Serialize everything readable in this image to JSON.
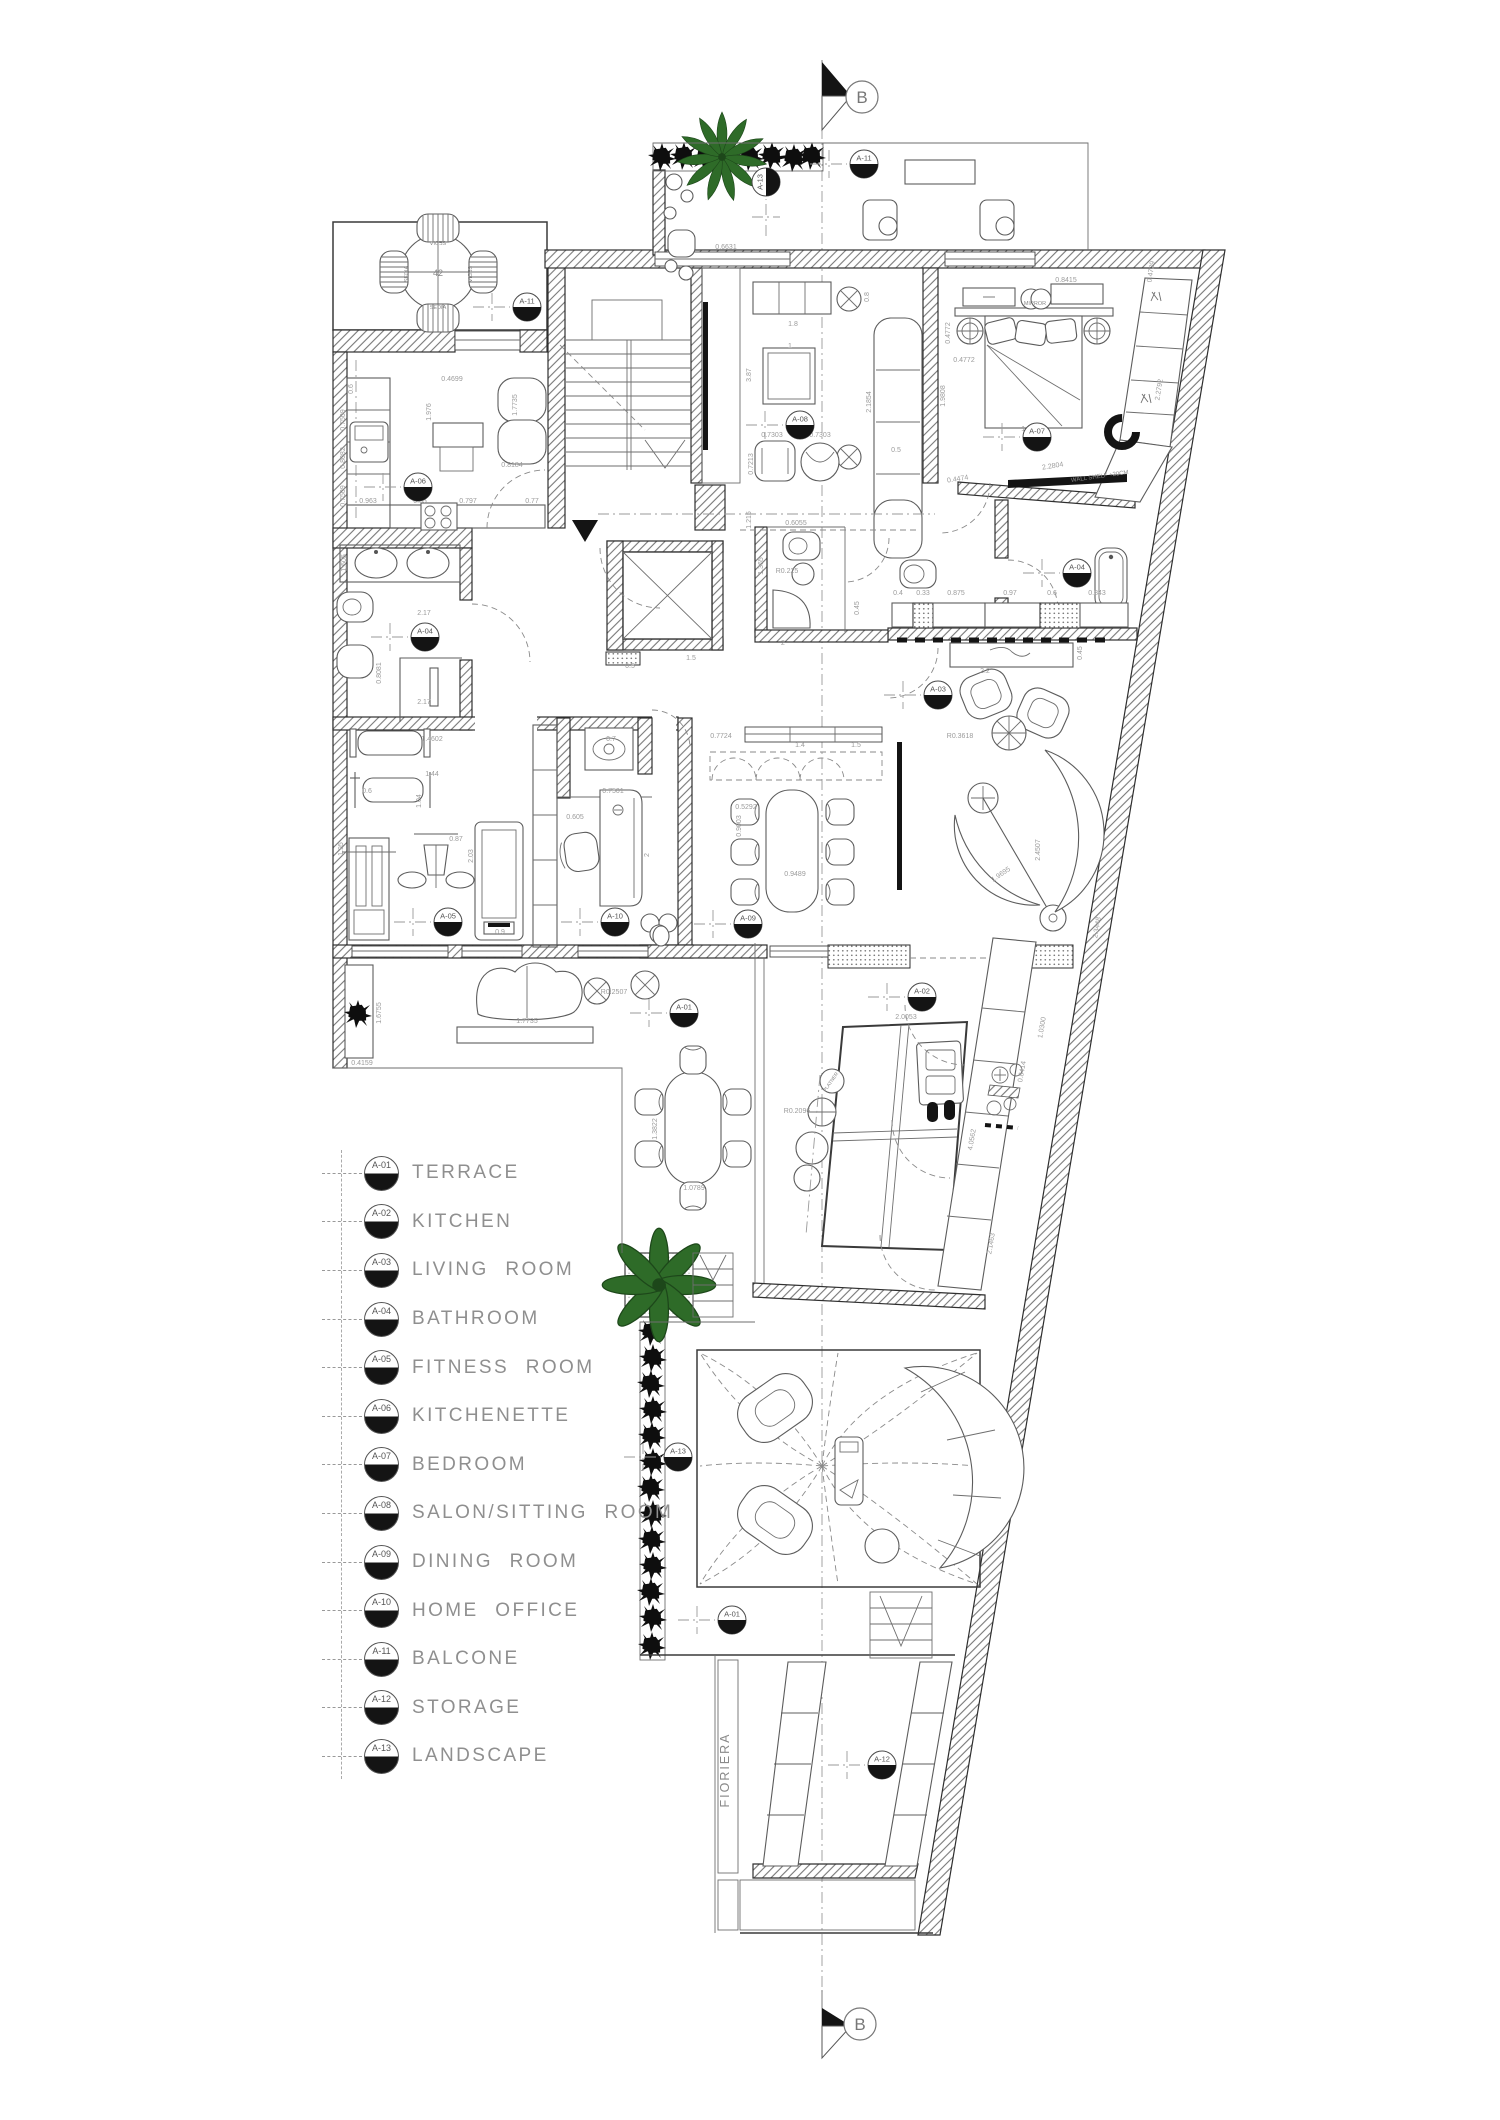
{
  "section": {
    "label": "B"
  },
  "legend": {
    "items": [
      {
        "id": "A-01",
        "label": "TERRACE"
      },
      {
        "id": "A-02",
        "label": "KITCHEN"
      },
      {
        "id": "A-03",
        "label": "LIVING ROOM"
      },
      {
        "id": "A-04",
        "label": "BATHROOM"
      },
      {
        "id": "A-05",
        "label": "FITNESS ROOM"
      },
      {
        "id": "A-06",
        "label": "KITCHENETTE"
      },
      {
        "id": "A-07",
        "label": "BEDROOM"
      },
      {
        "id": "A-08",
        "label": "SALON/SITTING ROOM"
      },
      {
        "id": "A-09",
        "label": "DINING ROOM"
      },
      {
        "id": "A-10",
        "label": "HOME OFFICE"
      },
      {
        "id": "A-11",
        "label": "BALCONE"
      },
      {
        "id": "A-12",
        "label": "STORAGE"
      },
      {
        "id": "A-13",
        "label": "LANDSCAPE"
      }
    ]
  },
  "plan": {
    "colors": {
      "wall": "#2f2f2f",
      "dim_text": "#9b9b9b",
      "label_text": "#8a8a8a",
      "plant_green": "#2e6b28",
      "hedge_black": "#111111",
      "legend_text": "#8f8f8f"
    },
    "markers": [
      {
        "id": "A-11",
        "x": 527,
        "y": 307
      },
      {
        "id": "A-13",
        "x": 766,
        "y": 182,
        "r": -90
      },
      {
        "id": "A-11",
        "x": 864,
        "y": 164
      },
      {
        "id": "A-08",
        "x": 800,
        "y": 425
      },
      {
        "id": "A-07",
        "x": 1037,
        "y": 437
      },
      {
        "id": "A-06",
        "x": 418,
        "y": 487
      },
      {
        "id": "A-04",
        "x": 425,
        "y": 637
      },
      {
        "id": "A-04",
        "x": 1077,
        "y": 573
      },
      {
        "id": "A-03",
        "x": 938,
        "y": 695
      },
      {
        "id": "A-05",
        "x": 448,
        "y": 922
      },
      {
        "id": "A-10",
        "x": 615,
        "y": 922
      },
      {
        "id": "A-09",
        "x": 748,
        "y": 924
      },
      {
        "id": "A-01",
        "x": 684,
        "y": 1013
      },
      {
        "id": "A-02",
        "x": 922,
        "y": 997
      },
      {
        "id": "A-13",
        "x": 678,
        "y": 1457
      },
      {
        "id": "A-01",
        "x": 732,
        "y": 1620
      },
      {
        "id": "A-12",
        "x": 882,
        "y": 1765
      }
    ],
    "dimensions": [
      {
        "t": "0.6631",
        "x": 726,
        "y": 249
      },
      {
        "t": "3.87",
        "x": 751,
        "y": 375,
        "r": -90
      },
      {
        "t": "1.215",
        "x": 751,
        "y": 520,
        "r": -90
      },
      {
        "t": "1.8",
        "x": 793,
        "y": 326
      },
      {
        "t": "1",
        "x": 790,
        "y": 348
      },
      {
        "t": "0.8",
        "x": 869,
        "y": 297,
        "r": -90
      },
      {
        "t": "2.1854",
        "x": 871,
        "y": 402,
        "r": -90
      },
      {
        "t": "0.7303",
        "x": 772,
        "y": 437
      },
      {
        "t": "0.7303",
        "x": 820,
        "y": 437
      },
      {
        "t": "0.7213",
        "x": 753,
        "y": 464,
        "r": -90
      },
      {
        "t": "0.5",
        "x": 896,
        "y": 452
      },
      {
        "t": "0.8415",
        "x": 1066,
        "y": 282
      },
      {
        "t": "0.4772",
        "x": 950,
        "y": 333,
        "r": -90
      },
      {
        "t": "0.4772",
        "x": 964,
        "y": 362
      },
      {
        "t": "1.9808",
        "x": 945,
        "y": 396,
        "r": -90
      },
      {
        "t": "1.7455",
        "x": 1032,
        "y": 431
      },
      {
        "t": "2.2804",
        "x": 1053,
        "y": 468,
        "r": -9
      },
      {
        "t": "0.4474",
        "x": 958,
        "y": 481,
        "r": -9
      },
      {
        "t": "2.2792",
        "x": 1161,
        "y": 390,
        "r": -81
      },
      {
        "t": "0.4729",
        "x": 1153,
        "y": 272,
        "r": -81
      },
      {
        "t": "0.4699",
        "x": 452,
        "y": 381
      },
      {
        "t": "1.976",
        "x": 431,
        "y": 412,
        "r": -90
      },
      {
        "t": "1.7735",
        "x": 517,
        "y": 405,
        "r": -90
      },
      {
        "t": "0.8184",
        "x": 512,
        "y": 467
      },
      {
        "t": "0.963",
        "x": 368,
        "y": 503
      },
      {
        "t": "0.55",
        "x": 420,
        "y": 503
      },
      {
        "t": "0.797",
        "x": 468,
        "y": 503
      },
      {
        "t": "0.77",
        "x": 532,
        "y": 503
      },
      {
        "t": "0.6",
        "x": 353,
        "y": 389,
        "r": -90
      },
      {
        "t": "0.7509",
        "x": 345,
        "y": 420,
        "r": -90
      },
      {
        "t": "0.8082",
        "x": 345,
        "y": 458,
        "r": -90
      },
      {
        "t": "0.7509",
        "x": 345,
        "y": 496,
        "r": -90
      },
      {
        "t": "2.17",
        "x": 424,
        "y": 615
      },
      {
        "t": "2.17",
        "x": 424,
        "y": 704
      },
      {
        "t": "1.505",
        "x": 346,
        "y": 563,
        "r": -90
      },
      {
        "t": "0.8081",
        "x": 381,
        "y": 673,
        "r": -90
      },
      {
        "t": "1.4602",
        "x": 432,
        "y": 741
      },
      {
        "t": "1.44",
        "x": 432,
        "y": 776
      },
      {
        "t": "0.6",
        "x": 367,
        "y": 793
      },
      {
        "t": "1.95",
        "x": 343,
        "y": 849,
        "r": -90
      },
      {
        "t": "1.04",
        "x": 421,
        "y": 801,
        "r": -90
      },
      {
        "t": "0.87",
        "x": 456,
        "y": 841
      },
      {
        "t": "2.03",
        "x": 473,
        "y": 856,
        "r": -90
      },
      {
        "t": "0.9",
        "x": 500,
        "y": 934
      },
      {
        "t": "0.7",
        "x": 611,
        "y": 741
      },
      {
        "t": "0.7501",
        "x": 613,
        "y": 793
      },
      {
        "t": "0.605",
        "x": 575,
        "y": 819
      },
      {
        "t": "2",
        "x": 649,
        "y": 855,
        "r": -90
      },
      {
        "t": "0.7724",
        "x": 721,
        "y": 738
      },
      {
        "t": "1.4",
        "x": 800,
        "y": 747
      },
      {
        "t": "1.5",
        "x": 856,
        "y": 747
      },
      {
        "t": "0.5292",
        "x": 746,
        "y": 809
      },
      {
        "t": "0.9003",
        "x": 741,
        "y": 826,
        "r": -90
      },
      {
        "t": "0.9489",
        "x": 795,
        "y": 876
      },
      {
        "t": "0.5",
        "x": 630,
        "y": 668
      },
      {
        "t": "1.5",
        "x": 691,
        "y": 660
      },
      {
        "t": "2",
        "x": 783,
        "y": 645
      },
      {
        "t": "1.365",
        "x": 763,
        "y": 566,
        "r": -90
      },
      {
        "t": "0.6055",
        "x": 796,
        "y": 525
      },
      {
        "t": "R0.225",
        "x": 787,
        "y": 573
      },
      {
        "t": "0.4",
        "x": 898,
        "y": 595
      },
      {
        "t": "0.33",
        "x": 923,
        "y": 595
      },
      {
        "t": "0.875",
        "x": 956,
        "y": 595
      },
      {
        "t": "0.97",
        "x": 1010,
        "y": 595
      },
      {
        "t": "0.6",
        "x": 1052,
        "y": 595
      },
      {
        "t": "0.843",
        "x": 1097,
        "y": 595
      },
      {
        "t": "0.45",
        "x": 859,
        "y": 608,
        "r": -90
      },
      {
        "t": "2.2",
        "x": 985,
        "y": 673
      },
      {
        "t": "0.45",
        "x": 1082,
        "y": 653,
        "r": -90
      },
      {
        "t": "R0.3618",
        "x": 960,
        "y": 738
      },
      {
        "t": "2.4507",
        "x": 1040,
        "y": 850,
        "r": -90
      },
      {
        "t": "1.9695",
        "x": 1002,
        "y": 876,
        "r": -34
      },
      {
        "t": "2.3448",
        "x": 1099,
        "y": 928,
        "r": -80
      },
      {
        "t": "1.6755",
        "x": 381,
        "y": 1013,
        "r": -90
      },
      {
        "t": "0.4159",
        "x": 362,
        "y": 1065
      },
      {
        "t": "1.7735",
        "x": 527,
        "y": 1023
      },
      {
        "t": "R0.2507",
        "x": 614,
        "y": 994
      },
      {
        "t": "1.3822",
        "x": 657,
        "y": 1129,
        "r": -90
      },
      {
        "t": "1.0789",
        "x": 694,
        "y": 1190
      },
      {
        "t": "2.0053",
        "x": 906,
        "y": 1019
      },
      {
        "t": "R0.2096",
        "x": 797,
        "y": 1113
      },
      {
        "t": "4.0562",
        "x": 974,
        "y": 1140,
        "r": -80
      },
      {
        "t": "1.0300",
        "x": 1044,
        "y": 1028,
        "r": -80
      },
      {
        "t": "0.8414",
        "x": 1024,
        "y": 1072,
        "r": -80
      },
      {
        "t": "2.1463",
        "x": 993,
        "y": 1244,
        "r": -80
      }
    ],
    "texts": [
      {
        "t": "42",
        "x": 438,
        "y": 276,
        "s": 9
      },
      {
        "t": "SEDIA",
        "x": 438,
        "y": 241,
        "s": 5.5,
        "r": 180
      },
      {
        "t": "SEDIA",
        "x": 438,
        "y": 309,
        "s": 5.5
      },
      {
        "t": "SEDIA",
        "x": 408,
        "y": 274,
        "s": 5.5,
        "r": -90
      },
      {
        "t": "SEDIA",
        "x": 468,
        "y": 274,
        "s": 5.5,
        "r": 90
      },
      {
        "t": "MIRROR",
        "x": 1035,
        "y": 305,
        "s": 5.5
      },
      {
        "t": "WALL SHELF +20CM",
        "x": 1100,
        "y": 478,
        "s": 6,
        "r": -8
      },
      {
        "t": "PLATNER",
        "x": 832,
        "y": 1083,
        "s": 5,
        "r": -55
      },
      {
        "t": "FIORIERA",
        "x": 729,
        "y": 1770,
        "s": 12.5,
        "r": -90
      }
    ]
  }
}
